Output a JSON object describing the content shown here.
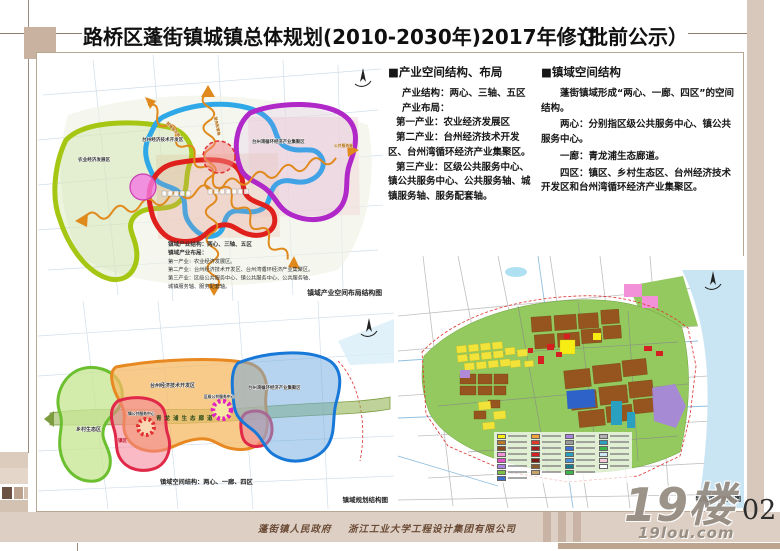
{
  "page": {
    "title": "路桥区蓬街镇城镇总体规划(2010-2030年)2017年修订",
    "subtitle": "（批前公示）",
    "page_number": "02"
  },
  "watermark": {
    "logo": "19楼",
    "site": "19lou.com"
  },
  "footer": {
    "government": "蓬街镇人民政府",
    "company": "浙江工业大学工程设计集团有限公司"
  },
  "sections": {
    "industry": {
      "heading": "■产业空间结构、布局",
      "lines": [
        "产业结构：两心、三轴、五区",
        "产业布局：",
        "第一产业：农业经济发展区",
        "第二产业：台州经济技术开发区、台州湾循环经济产业集聚区。",
        "第三产业：区级公共服务中心、镇公共服务中心、公共服务轴、城镇服务轴、服务配套轴。"
      ]
    },
    "domain": {
      "heading": "■镇域空间结构",
      "paragraphs": [
        "蓬街镇域形成“两心、一廊、四区”的空间结构。",
        "两心：分别指区级公共服务中心、镇公共服务中心。",
        "一廊：青龙浦生态廊道。",
        "四区：镇区、乡村生态区、台州经济技术开发区和台州湾循环经济产业集聚区。"
      ]
    }
  },
  "map_industry": {
    "caption": "镇域产业空间布局结构图",
    "labels": {
      "agri": "农业经济发展区",
      "tech": "台州经济技术开发区",
      "circular": "台州湾循环经济产业集聚区"
    },
    "axis_labels": {
      "public": "公共服务轴",
      "town": "城镇服务轴",
      "support": "服务配套轴"
    },
    "annotation": [
      "镇域产业结构：两心、三轴、五区",
      "镇域产业布局：",
      "第一产业：农业经济发展区。",
      "第二产业：台州经济技术开发区、台州湾循环经济产业集聚区。",
      "第三产业：区级公共服务中心、镇公共服务中心、公共服务轴、",
      "城镇服务轴、服务配套轴。"
    ]
  },
  "map_structure": {
    "caption": "镇域规划结构图",
    "inner_caption": "镇域空间结构：两心、一廊、四区",
    "labels": {
      "rural": "乡村生态区",
      "tech": "台州经济技术开发区",
      "industry": "台州湾循环经济产业集聚区",
      "town": "镇区",
      "corridor": "青龙浦生态廊道",
      "district_center": "区级公共服务中心",
      "town_center": "镇公共服务中心"
    }
  },
  "map_landuse": {
    "caption": "镇域用地规划图",
    "legend_columns": [
      [
        "#f7ec13",
        "#b97a2a",
        "#8a4a1e",
        "#f291d8",
        "#e24fc8",
        "#a883e0",
        "#7ac143",
        "#3e6fd0"
      ],
      [
        "#f2a33a",
        "#e03a2a",
        "#a02020",
        "#d42020",
        "#7a1a10",
        "#8a5a2a",
        "#c9a36a"
      ],
      [
        "#a883e0",
        "#9a9a9a",
        "#3e6fd0",
        "#2aa0c0",
        "#4a90d8",
        "#1a7a8a",
        "#3cb44a"
      ],
      [
        "#b0b0b0",
        "#2aa0c0",
        "#3cb44a",
        "#cfe8f5",
        "#f5c9d8",
        "#ffffff"
      ]
    ]
  },
  "colors": {
    "frame_tan": "#c9b2a0",
    "footer_strip": "#ddcfc4",
    "agri_green": "#a6c614",
    "town_red": "#e0201c",
    "tech_blue": "#2fa8e8",
    "circular_purple": "#b028c8",
    "axis_orange": "#e08a1e",
    "eco_green": "#6cc030",
    "zone_orange": "#e88820",
    "zone_red": "#e02848",
    "zone_blue": "#1878d8",
    "corridor_green": "#7d9c40",
    "center_magenta": "#e020c0",
    "center_red": "#e03030",
    "landuse_green": "#93c95e",
    "landuse_brown": "#96551f",
    "landuse_yellow": "#f2e33a",
    "sea_blue": "#c9e5f4"
  }
}
